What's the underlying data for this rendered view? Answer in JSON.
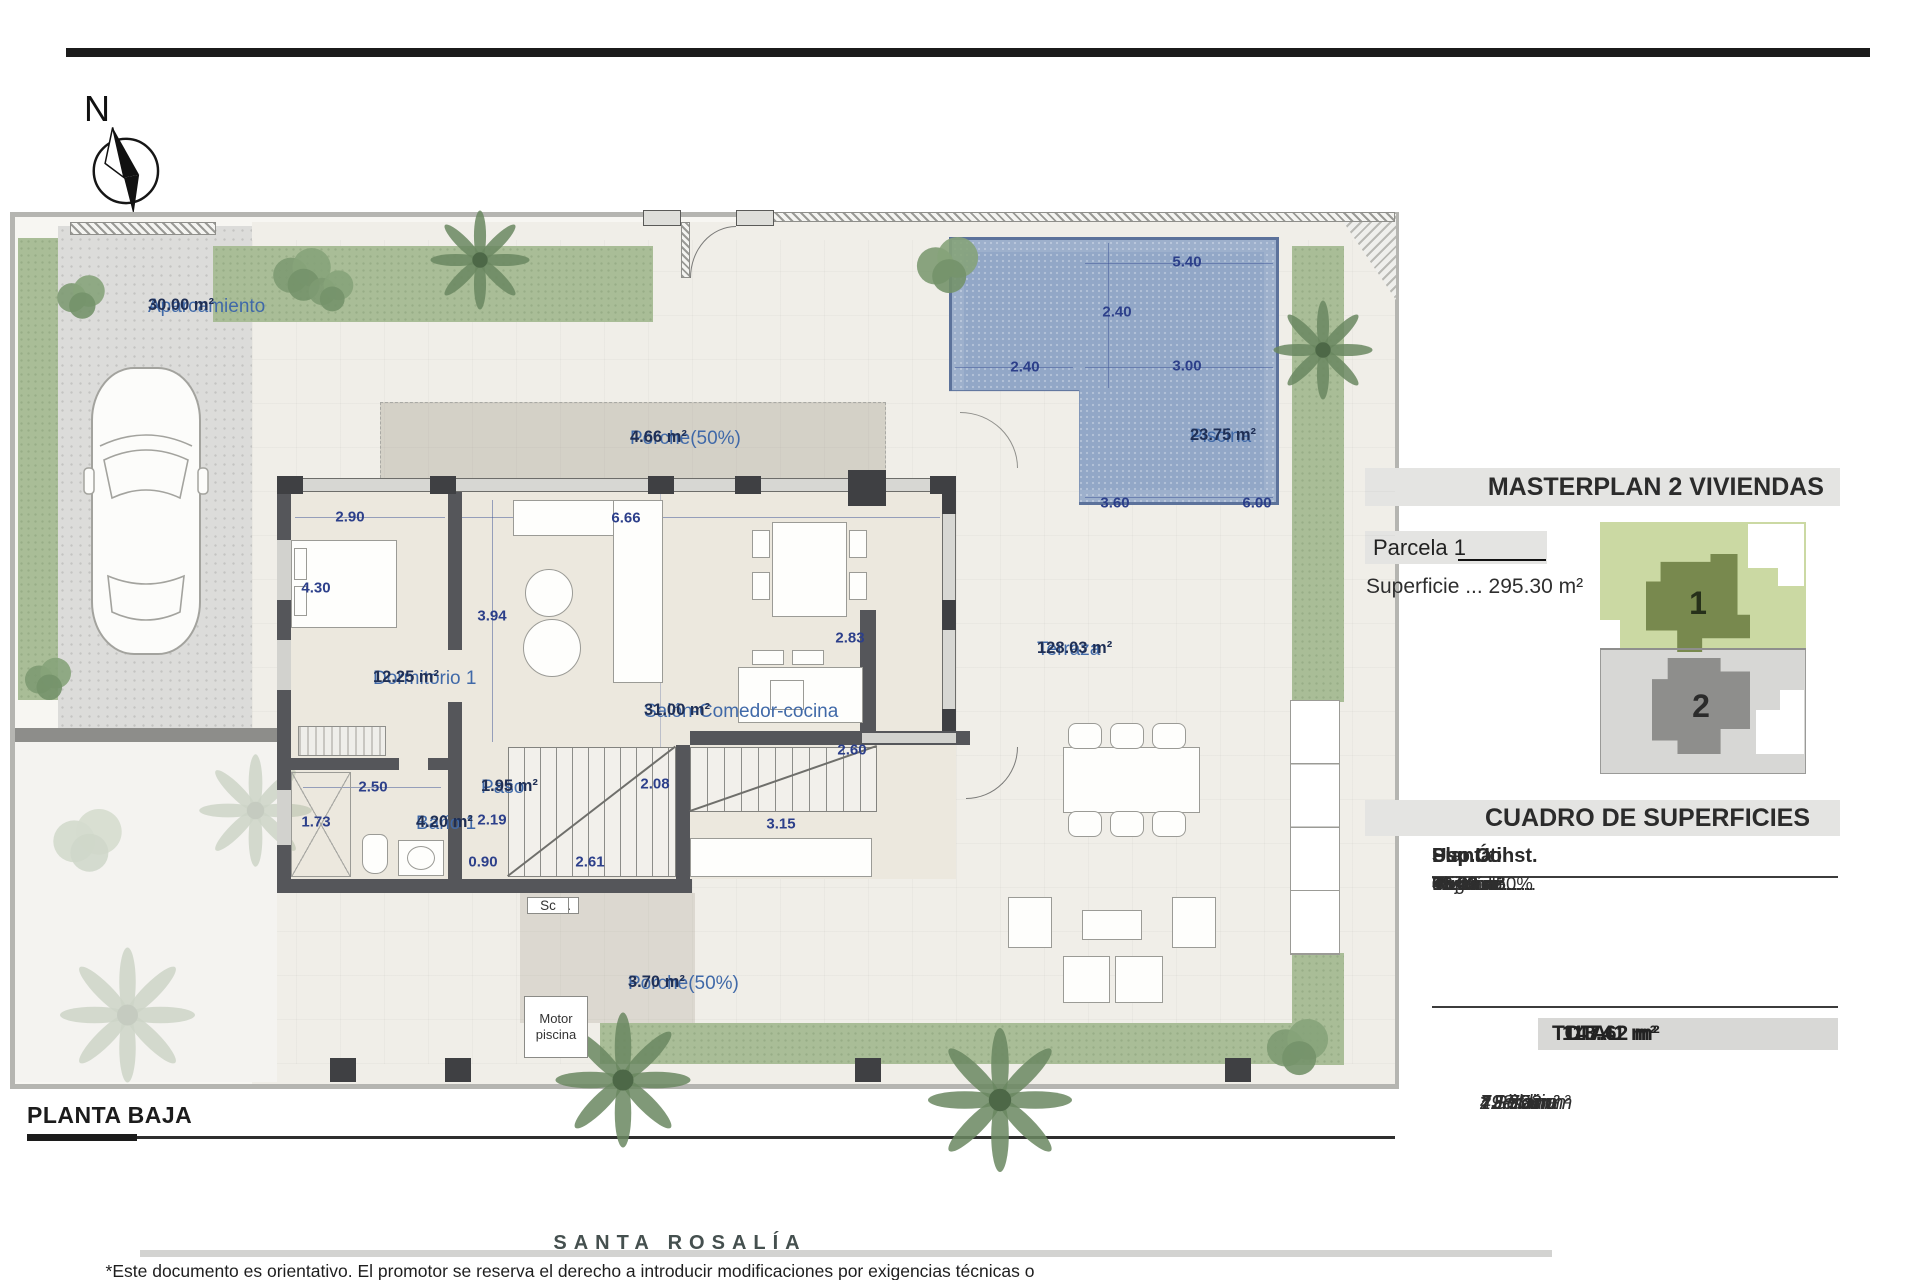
{
  "colors": {
    "accent": "#2c3f8a",
    "labelBlue": "#4069a8",
    "areaNavy": "#1f2f55",
    "pool": "#92a7c7",
    "poolEdge": "#5c729b",
    "green": "#a9bd97",
    "wall": "#55565a",
    "pillar": "#3f4043",
    "beige": "#f0eee8"
  },
  "compass": {
    "north_label": "N"
  },
  "plan": {
    "title": "PLANTA BAJA",
    "labels": [
      {
        "id": "aparcamiento",
        "name": "Aparcamiento",
        "area": "30.00 m²",
        "x": 148,
        "y": 296
      },
      {
        "id": "porche-superior",
        "name": "Porche(50%)",
        "area": "4.66 m²",
        "x": 630,
        "y": 428
      },
      {
        "id": "dormitorio-1",
        "name": "Dormitorio 1",
        "area": "12.25 m²",
        "x": 373,
        "y": 668
      },
      {
        "id": "salon-comedor-cocina",
        "name": "Salón-Comedor-cocina",
        "area": "31.00 m²",
        "x": 644,
        "y": 701
      },
      {
        "id": "paso",
        "name": "Paso",
        "area": "1.95 m²",
        "x": 481,
        "y": 777
      },
      {
        "id": "bano-1",
        "name": "Baño 1",
        "area": "4.20 m²",
        "x": 416,
        "y": 813
      },
      {
        "id": "terraza",
        "name": "Terraza",
        "area": "128.03 m²",
        "x": 1037,
        "y": 639
      },
      {
        "id": "piscina",
        "name": "Piscina",
        "area": "23.75 m²",
        "x": 1190,
        "y": 426
      },
      {
        "id": "porche-inferior",
        "name": "Porche(50%)",
        "area": "3.70 m²",
        "x": 628,
        "y": 973
      }
    ],
    "dimensions": [
      {
        "t": "2.90",
        "x": 350,
        "y": 517
      },
      {
        "t": "4.30",
        "x": 316,
        "y": 588
      },
      {
        "t": "6.66",
        "x": 626,
        "y": 518
      },
      {
        "t": "3.94",
        "x": 492,
        "y": 616
      },
      {
        "t": "2.83",
        "x": 850,
        "y": 638
      },
      {
        "t": "2.60",
        "x": 852,
        "y": 750
      },
      {
        "t": "2.50",
        "x": 373,
        "y": 787
      },
      {
        "t": "2.08",
        "x": 655,
        "y": 784
      },
      {
        "t": "1.73",
        "x": 316,
        "y": 822
      },
      {
        "t": "2.19",
        "x": 492,
        "y": 820
      },
      {
        "t": "0.90",
        "x": 483,
        "y": 862
      },
      {
        "t": "2.61",
        "x": 590,
        "y": 862
      },
      {
        "t": "3.15",
        "x": 781,
        "y": 824
      },
      {
        "t": "5.40",
        "x": 1187,
        "y": 262
      },
      {
        "t": "2.40",
        "x": 1117,
        "y": 312
      },
      {
        "t": "2.40",
        "x": 1025,
        "y": 367
      },
      {
        "t": "3.00",
        "x": 1187,
        "y": 366
      },
      {
        "t": "3.60",
        "x": 1115,
        "y": 503
      },
      {
        "t": "6.00",
        "x": 1257,
        "y": 503
      }
    ],
    "equipment": {
      "aerot": "Aerot.",
      "lvd": "Lvd",
      "sc": "Sc",
      "motor": "Motor piscina"
    }
  },
  "masterplan": {
    "title": "MASTERPLAN 2 VIVIENDAS",
    "parcel": "Parcela 1",
    "superficie": "Superficie ... 295.30 m²",
    "plot1": "1",
    "plot2": "2"
  },
  "surfaces": {
    "title": "CUADRO DE SUPERFICIES",
    "columns": [
      "Planta",
      "Uso",
      "Sup.Útil",
      "Sup.Const."
    ],
    "rows": [
      [
        "Baja ........",
        "Vivienda......",
        "49.40 m²......",
        "61.23 m²"
      ],
      [
        "",
        "Porche 50%",
        "08.36 m²......",
        "08.36 m²"
      ],
      [
        "Primera....",
        "Vivienda......",
        "53.60 m²......",
        "68.00 m²"
      ],
      [
        "Segunda...",
        "Torreón......",
        "02.05 m²......",
        "11.03 m²"
      ]
    ],
    "total_label": "TOTAL",
    "total_util": "113.41 m²",
    "total_const": "147.62 m²"
  },
  "extras": [
    {
      "label": "* Piscina",
      "value": "23.75 m²"
    },
    {
      "label": "* Jardín",
      "value": "128.03 m²"
    },
    {
      "label": "* Sótano",
      "value": "73.70 m²"
    },
    {
      "label": "* Solarium",
      "value": "49.95 m²"
    }
  ],
  "footer": {
    "brand": "SANTA ROSALÍA",
    "disclaimer": "*Este documento es orientativo. El promotor se reserva el derecho a introducir modificaciones por exigencias técnicas o legales."
  }
}
